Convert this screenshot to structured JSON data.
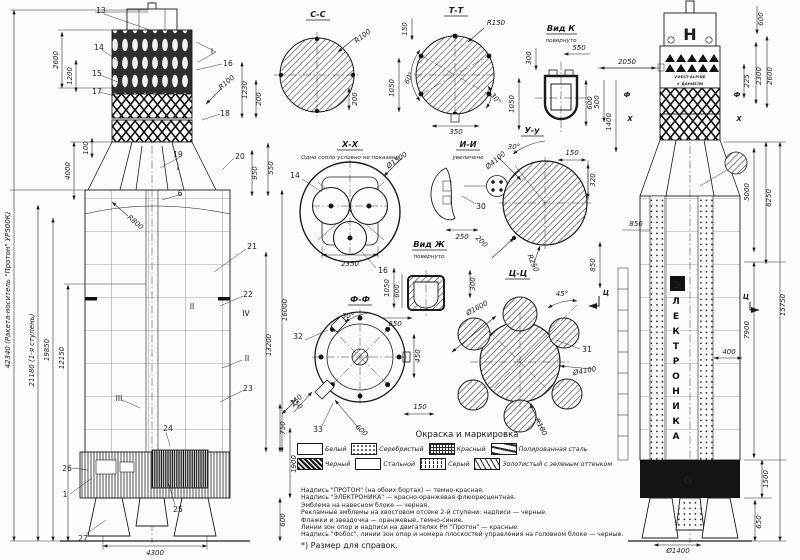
{
  "margin": {
    "total": "42340 (Ракета-носитель \"Протон\" УР500К)",
    "stage1": "21180 (1-я ступень)",
    "d19850": "19850",
    "d12150": "12150",
    "d2600": "2600",
    "d1200": "1200",
    "d4000": "4000",
    "d100": "100"
  },
  "left": {
    "callouts": {
      "c1": "1",
      "c6": "6",
      "c13": "13",
      "c14": "14",
      "c15": "15",
      "c16": "16",
      "c17": "17",
      "c18": "18",
      "c19": "19",
      "c20": "20",
      "c21": "21",
      "c22": "22",
      "c23": "23",
      "c24": "24",
      "c25": "25",
      "c26": "26",
      "c27": "27",
      "pI": "I",
      "pIb": "I",
      "pII": "II",
      "pIIb": "II",
      "pIII": "III",
      "pIV": "IV"
    },
    "dims": {
      "r100": "R100",
      "d1230": "1230",
      "d200": "200",
      "d950": "950",
      "d550": "550",
      "r800": "R800",
      "d16000": "16000",
      "d13200": "13200",
      "d250": "250",
      "d750": "750",
      "d1900": "1900",
      "d600": "600",
      "d4300": "4300"
    }
  },
  "views": {
    "cc": {
      "title": "С-С",
      "r100": "R100",
      "d200": "200"
    },
    "tt": {
      "title": "Т-Т",
      "r150": "R150",
      "d150": "150",
      "d1050": "1050",
      "a60": "60°",
      "a30": "30°",
      "d350": "350"
    },
    "vidk": {
      "title": "Вид К",
      "sub": "повернуто",
      "d300": "300",
      "d550": "550",
      "d1050": "1050",
      "d600": "600"
    },
    "xx": {
      "title": "Х-Х",
      "note": "Одно сопло условно не показано",
      "c14": "14",
      "c16": "16",
      "dia1500": "Ø1500",
      "d2350": "2350"
    },
    "ii": {
      "title": "И-И",
      "sub": "увеличено",
      "c30": "30",
      "d250": "250"
    },
    "uu": {
      "title": "У-у",
      "a30": "30°",
      "dia4100": "Ø4100",
      "d150": "150",
      "d320": "320",
      "d200": "200",
      "r250": "R250"
    },
    "vidzh": {
      "title": "Вид Ж",
      "sub": "повернуто",
      "d1050": "1050",
      "d600": "600",
      "d300": "300",
      "d650": "650"
    },
    "ff": {
      "title": "Ф-Ф",
      "a30": "30°",
      "c32": "32",
      "c33": "33",
      "d450": "450",
      "d150": "150",
      "d250": "250",
      "d600": "600"
    },
    "cicy": {
      "title": "Ц-Ц",
      "dia1600": "Ø1600",
      "a45": "45°",
      "c31": "31",
      "dia4100": "Ø4100",
      "r100": "R100",
      "cut": "Ц"
    }
  },
  "right": {
    "emblem_top": "Н",
    "logo1": "VOEST-ALPINE",
    "logo2": "★ ДАНИЕЛИ",
    "emblem_e": "Э",
    "body_text": "ЛЕКТРОНИКА",
    "emblem_g": "G",
    "dims": {
      "d2050": "2050",
      "d500": "500",
      "d1400": "1400",
      "d225": "225",
      "d2300": "2300",
      "d2600": "2600",
      "d600": "600",
      "d850a": "850",
      "d850b": "850",
      "d5000": "5000",
      "d6250": "6250",
      "d15750": "15750",
      "d7900": "7900",
      "d400": "400",
      "d1500": "1500",
      "d650": "650",
      "dia1400": "Ø1400"
    },
    "marks": {
      "f": "Ф",
      "x": "Х",
      "f2": "Ф",
      "x2": "Х",
      "c": "Ц"
    }
  },
  "legend": {
    "title": "Окраска и маркировка",
    "items": [
      {
        "label": "Белый"
      },
      {
        "label": "Серебристый"
      },
      {
        "label": "Красный"
      },
      {
        "label": "Полированная сталь"
      },
      {
        "label": "Черный"
      },
      {
        "label": "Стальной"
      },
      {
        "label": "Серый"
      },
      {
        "label": "Золотистый с зеленым оттенком"
      }
    ]
  },
  "notes": {
    "lines": [
      "Надпись \"ПРОТОН\" (на обоих бортах) — темно-красная.",
      "Надпись \"ЭЛЕКТРОНИКА\" — красно-оранжевая флюоресцентная.",
      "Эмблема на навесном блоке — черная.",
      "Рекламные эмблемы на хвостовом отсеке 2-й ступени: надписи — черные.",
      "Флажки и звездочка — оранжевые, темно-синие.",
      "Линии зон опор и надписи на двигателях РН \"Протон\" — красные.",
      "Надпись \"Фобос\", линии зон опор и номера плоскостей управления на головном блоке — черные."
    ],
    "footnote": "*) Размер для справок."
  }
}
